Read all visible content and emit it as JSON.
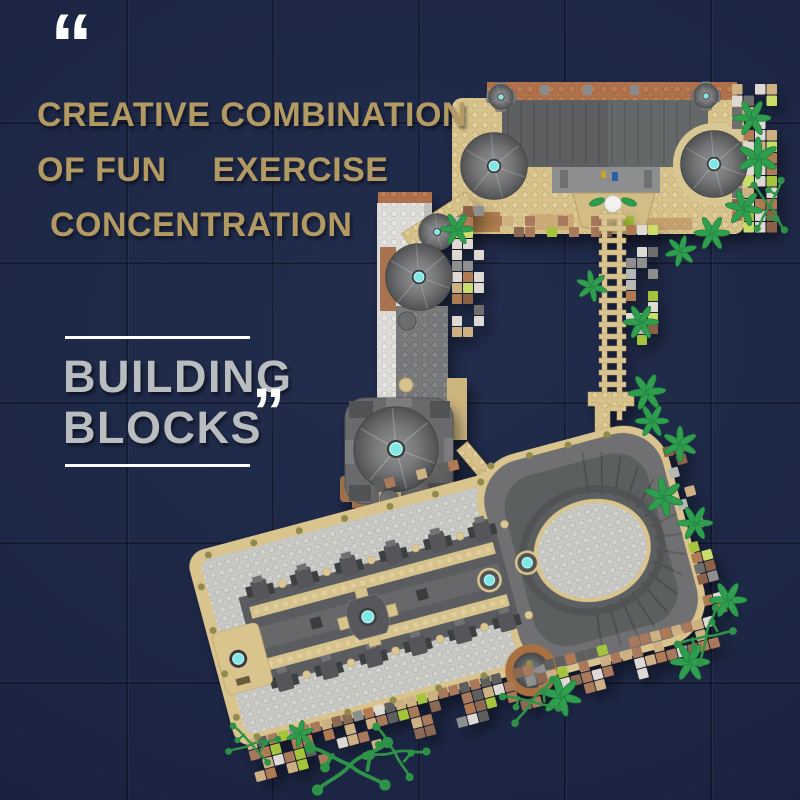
{
  "headline": {
    "open_quote": "“",
    "close_quote": "”",
    "line1": "CREATIVE COMBINATION",
    "line2_part1": "OF FUN",
    "line2_part2": "EXERCISE",
    "line3": "CONCENTRATION"
  },
  "subtitle": {
    "line1": "BUILDING",
    "line2": "BLOCKS"
  },
  "colors": {
    "background": "#1c2644",
    "headline_gold": "#b39a63",
    "subtitle_silver": "#babdbf",
    "quote_white": "#ffffff",
    "brick_tan": "#d9c48e",
    "brick_brown": "#ad7450",
    "roof_gray": "#5e6062",
    "plate_light": "#c8c8c4",
    "stud_cyan": "#7fe8e6",
    "foliage_green": "#2f9e4e",
    "moss_lime": "#b2cc3f"
  }
}
